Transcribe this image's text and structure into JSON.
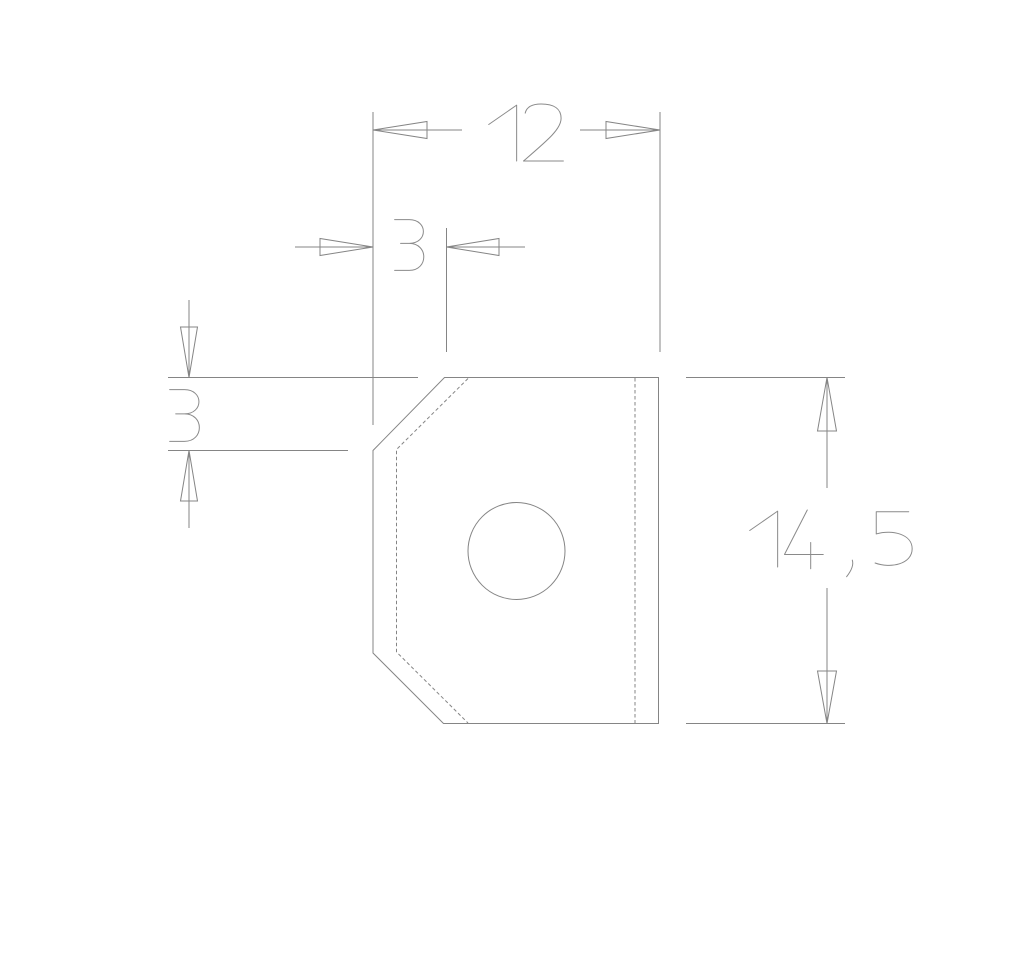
{
  "drawing": {
    "background_color": "#ffffff",
    "line_color": "#858585",
    "dimensions": {
      "width": {
        "label": "12"
      },
      "chamfer_width": {
        "label": "3"
      },
      "chamfer_height": {
        "label": "3"
      },
      "height": {
        "label": "14 , 5"
      }
    }
  }
}
